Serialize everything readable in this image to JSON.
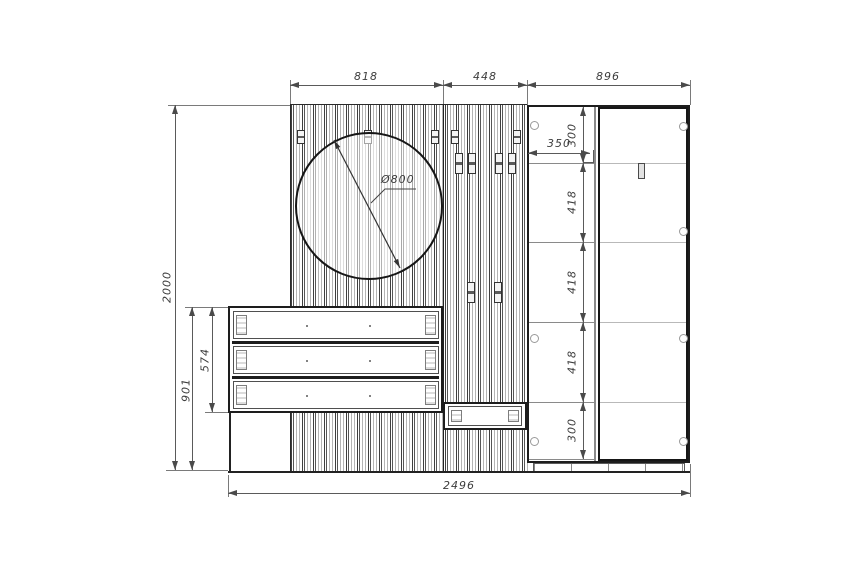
{
  "drawing": {
    "type": "furniture-technical-drawing",
    "top_dimensions": [
      {
        "label": "818"
      },
      {
        "label": "448"
      },
      {
        "label": "896"
      }
    ],
    "left_dimensions": {
      "total_height": "2000",
      "drawer_top_to_floor": "901",
      "drawer_unit_height": "574"
    },
    "bottom_dimension": {
      "total_width": "2496"
    },
    "mirror": {
      "diameter_label": "Ø800"
    },
    "wardrobe": {
      "shelf_width": "350",
      "section_heights": [
        "300",
        "418",
        "418",
        "418",
        "300"
      ]
    }
  }
}
